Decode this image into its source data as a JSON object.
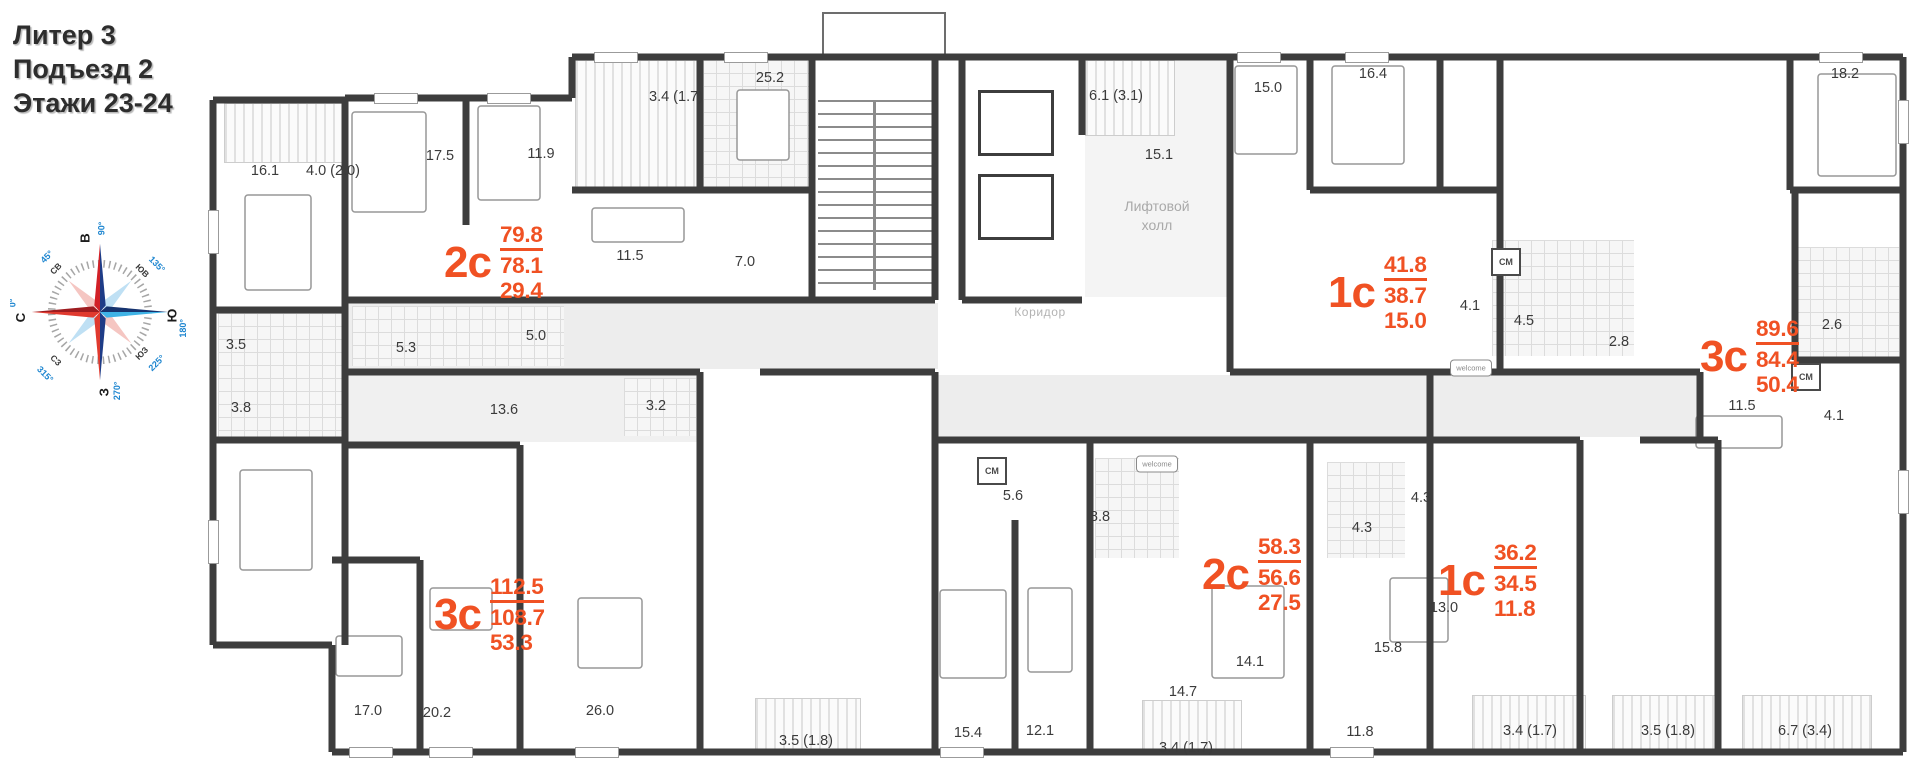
{
  "title": {
    "line1": "Литер 3",
    "line2": "Подъезд 2",
    "line3": "Этажи 23-24"
  },
  "colors": {
    "accent": "#f05123",
    "wall": "#3d3d3d",
    "room_text": "#3b3b3b",
    "muted_text": "#a9a9a9",
    "compass_red": "#d22027",
    "compass_dark_red": "#9e1c20",
    "compass_blue": "#1e3c87",
    "compass_light_blue": "#3fb3e6",
    "degree_blue": "#1e86d0"
  },
  "core": {
    "elevator_hall_line1": "Лифтовой",
    "elevator_hall_line2": "холл",
    "corridor": "Коридор"
  },
  "compass": {
    "n": "С",
    "n_deg": "0°",
    "e": "В",
    "e_deg": "90°",
    "s": "Ю",
    "s_deg": "180°",
    "w": "З",
    "w_deg": "270°",
    "ne": "СВ",
    "ne_deg": "45°",
    "se": "ЮВ",
    "se_deg": "135°",
    "sw": "ЮЗ",
    "sw_deg": "225°",
    "nw": "СЗ",
    "nw_deg": "315°"
  },
  "apartments": [
    {
      "id": "2c-top",
      "type": "2с",
      "area_total": "79.8",
      "area_living": "78.1",
      "area_kitchen": "29.4",
      "x": 444,
      "y": 222
    },
    {
      "id": "1c-top",
      "type": "1с",
      "area_total": "41.8",
      "area_living": "38.7",
      "area_kitchen": "15.0",
      "x": 1328,
      "y": 252
    },
    {
      "id": "3c-right",
      "type": "3с",
      "area_total": "89.6",
      "area_living": "84.4",
      "area_kitchen": "50.4",
      "x": 1700,
      "y": 316
    },
    {
      "id": "3c-bottom",
      "type": "3с",
      "area_total": "112.5",
      "area_living": "108.7",
      "area_kitchen": "53.3",
      "x": 434,
      "y": 574
    },
    {
      "id": "2c-bottom",
      "type": "2с",
      "area_total": "58.3",
      "area_living": "56.6",
      "area_kitchen": "27.5",
      "x": 1202,
      "y": 534
    },
    {
      "id": "1c-bottom",
      "type": "1с",
      "area_total": "36.2",
      "area_living": "34.5",
      "area_kitchen": "11.8",
      "x": 1438,
      "y": 540
    }
  ],
  "rooms": [
    {
      "label": "16.1",
      "x": 265,
      "y": 171
    },
    {
      "label": "4.0 (2.0)",
      "x": 333,
      "y": 171
    },
    {
      "label": "17.5",
      "x": 440,
      "y": 156
    },
    {
      "label": "11.9",
      "x": 541,
      "y": 154
    },
    {
      "label": "3.4 (1.7)",
      "x": 676,
      "y": 97
    },
    {
      "label": "25.2",
      "x": 770,
      "y": 78
    },
    {
      "label": "11.5",
      "x": 630,
      "y": 256
    },
    {
      "label": "7.0",
      "x": 745,
      "y": 262
    },
    {
      "label": "5.0",
      "x": 536,
      "y": 336
    },
    {
      "label": "5.3",
      "x": 406,
      "y": 348
    },
    {
      "label": "3.5",
      "x": 236,
      "y": 345
    },
    {
      "label": "3.8",
      "x": 241,
      "y": 408
    },
    {
      "label": "13.6",
      "x": 504,
      "y": 410
    },
    {
      "label": "3.2",
      "x": 656,
      "y": 406
    },
    {
      "label": "5.6",
      "x": 1013,
      "y": 496
    },
    {
      "label": "8.8",
      "x": 1100,
      "y": 517
    },
    {
      "label": "6.1 (3.1)",
      "x": 1116,
      "y": 96
    },
    {
      "label": "15.1",
      "x": 1159,
      "y": 155
    },
    {
      "label": "15.0",
      "x": 1268,
      "y": 88
    },
    {
      "label": "16.4",
      "x": 1373,
      "y": 74
    },
    {
      "label": "18.2",
      "x": 1845,
      "y": 74
    },
    {
      "label": "4.1",
      "x": 1470,
      "y": 306
    },
    {
      "label": "4.5",
      "x": 1524,
      "y": 321
    },
    {
      "label": "2.8",
      "x": 1619,
      "y": 342
    },
    {
      "label": "2.6",
      "x": 1832,
      "y": 325
    },
    {
      "label": "11.5",
      "x": 1742,
      "y": 406
    },
    {
      "label": "4.1",
      "x": 1834,
      "y": 416
    },
    {
      "label": "4.3",
      "x": 1362,
      "y": 528
    },
    {
      "label": "4.3",
      "x": 1421,
      "y": 498
    },
    {
      "label": "17.0",
      "x": 368,
      "y": 711
    },
    {
      "label": "20.2",
      "x": 437,
      "y": 713
    },
    {
      "label": "26.0",
      "x": 600,
      "y": 711
    },
    {
      "label": "3.5 (1.8)",
      "x": 806,
      "y": 741
    },
    {
      "label": "15.4",
      "x": 968,
      "y": 733
    },
    {
      "label": "12.1",
      "x": 1040,
      "y": 731
    },
    {
      "label": "14.7",
      "x": 1183,
      "y": 692
    },
    {
      "label": "3.4 (1.7)",
      "x": 1186,
      "y": 748
    },
    {
      "label": "11.8",
      "x": 1360,
      "y": 732
    },
    {
      "label": "14.1",
      "x": 1250,
      "y": 662
    },
    {
      "label": "15.8",
      "x": 1388,
      "y": 648
    },
    {
      "label": "13.0",
      "x": 1444,
      "y": 608
    },
    {
      "label": "3.4 (1.7)",
      "x": 1530,
      "y": 731
    },
    {
      "label": "3.5 (1.8)",
      "x": 1668,
      "y": 731
    },
    {
      "label": "6.7 (3.4)",
      "x": 1805,
      "y": 731
    }
  ],
  "appliance_badges": [
    {
      "label": "СМ",
      "x": 992,
      "y": 471
    },
    {
      "label": "СМ",
      "x": 1506,
      "y": 262
    },
    {
      "label": "СМ",
      "x": 1806,
      "y": 377
    }
  ],
  "doormats": [
    {
      "label": "welcome",
      "x": 1157,
      "y": 464
    },
    {
      "label": "welcome",
      "x": 1471,
      "y": 368
    }
  ]
}
